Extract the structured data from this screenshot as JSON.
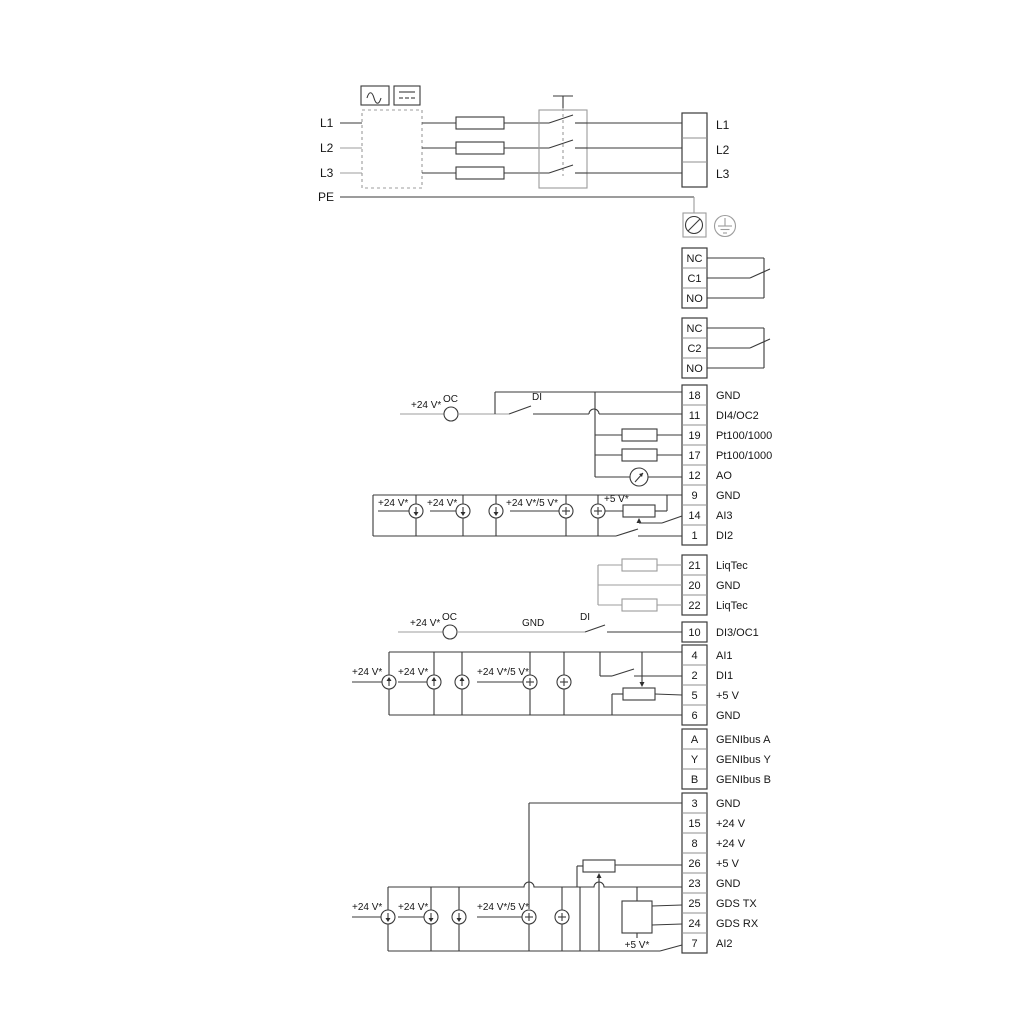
{
  "power": {
    "in": [
      "L1",
      "L2",
      "L3",
      "PE"
    ],
    "out": [
      "L1",
      "L2",
      "L3"
    ]
  },
  "relay1": [
    "NC",
    "C1",
    "NO"
  ],
  "relay2": [
    "NC",
    "C2",
    "NO"
  ],
  "io_top": {
    "rows": [
      {
        "n": "18",
        "l": "GND"
      },
      {
        "n": "11",
        "l": "DI4/OC2"
      },
      {
        "n": "19",
        "l": "Pt100/1000"
      },
      {
        "n": "17",
        "l": "Pt100/1000"
      },
      {
        "n": "12",
        "l": "AO"
      },
      {
        "n": "9",
        "l": "GND"
      },
      {
        "n": "14",
        "l": "AI3"
      },
      {
        "n": "1",
        "l": "DI2"
      }
    ]
  },
  "liqtec": {
    "rows": [
      {
        "n": "21",
        "l": "LiqTec"
      },
      {
        "n": "20",
        "l": "GND"
      },
      {
        "n": "22",
        "l": "LiqTec"
      }
    ]
  },
  "io_di3": {
    "rows": [
      {
        "n": "10",
        "l": "DI3/OC1"
      }
    ]
  },
  "io_mid": {
    "rows": [
      {
        "n": "4",
        "l": "AI1"
      },
      {
        "n": "2",
        "l": "DI1"
      },
      {
        "n": "5",
        "l": "+5 V"
      },
      {
        "n": "6",
        "l": "GND"
      }
    ]
  },
  "genibus": {
    "rows": [
      {
        "n": "A",
        "l": "GENIbus A"
      },
      {
        "n": "Y",
        "l": "GENIbus Y"
      },
      {
        "n": "B",
        "l": "GENIbus B"
      }
    ]
  },
  "io_bottom": {
    "rows": [
      {
        "n": "3",
        "l": "GND"
      },
      {
        "n": "15",
        "l": "+24 V"
      },
      {
        "n": "8",
        "l": "+24 V"
      },
      {
        "n": "26",
        "l": "+5 V"
      },
      {
        "n": "23",
        "l": "GND"
      },
      {
        "n": "25",
        "l": "GDS TX"
      },
      {
        "n": "24",
        "l": "GDS RX"
      },
      {
        "n": "7",
        "l": "AI2"
      }
    ]
  },
  "ann": {
    "di4_v24": "+24 V*",
    "di4_oc": "OC",
    "di4_di": "DI",
    "ai3_v24a": "+24 V*",
    "ai3_v24b": "+24 V*",
    "ai3_v245": "+24 V*/5 V*",
    "ai3_v5": "+5 V*",
    "di3_v24": "+24 V*",
    "di3_oc": "OC",
    "di3_gnd": "GND",
    "di3_di": "DI",
    "ai1_v24a": "+24 V*",
    "ai1_v24b": "+24 V*",
    "ai1_v245": "+24 V*/5 V*",
    "ai2_v24a": "+24 V*",
    "ai2_v24b": "+24 V*",
    "ai2_v245": "+24 V*/5 V*",
    "gds_v5": "+5 V*"
  },
  "colors": {
    "ink": "#3a3a3a",
    "gray": "#9c9c9c",
    "text": "#161616",
    "bg": "#ffffff"
  }
}
